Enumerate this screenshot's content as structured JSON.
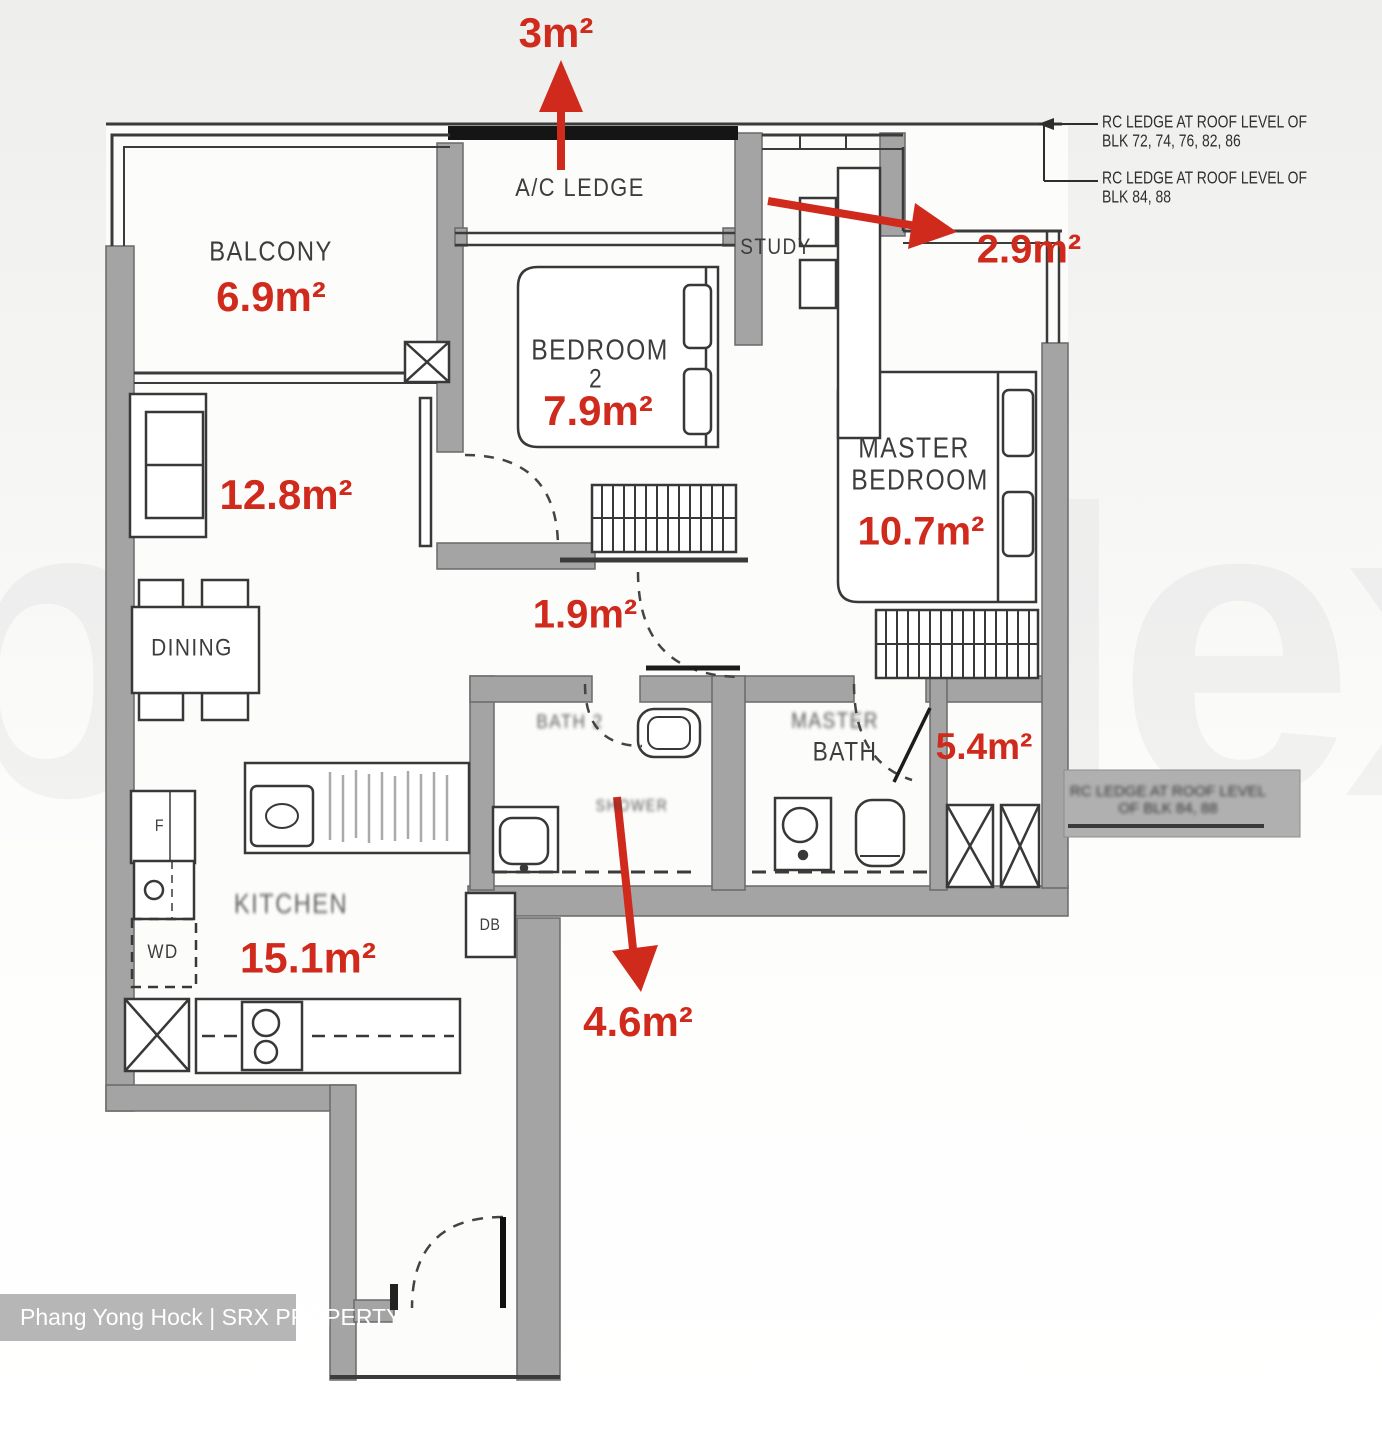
{
  "rooms": {
    "balcony": "BALCONY",
    "ac_ledge": "A/C LEDGE",
    "study": "STUDY",
    "bedroom2_line1": "BEDROOM",
    "bedroom2_line2": "2",
    "master_line1": "MASTER",
    "master_line2": "BEDROOM",
    "dining": "DINING",
    "master_bath_prefix": "MASTER",
    "master_bath": "BATH",
    "bath2": "BATH 2",
    "shower": "SHOWER",
    "kitchen": "KITCHEN"
  },
  "areas": {
    "ac_ledge": "3m²",
    "balcony": "6.9m²",
    "bedroom2": "7.9m²",
    "study": "2.9m²",
    "master_bedroom": "10.7m²",
    "living": "12.8m²",
    "hallway": "1.9m²",
    "master_bath": "5.4m²",
    "kitchen": "15.1m²",
    "foyer": "4.6m²"
  },
  "fixtures": {
    "db": "DB",
    "wd": "WD",
    "fridge": "F"
  },
  "notes": {
    "rc_note1_line1": "RC LEDGE AT ROOF LEVEL OF",
    "rc_note1_line2": "BLK 72, 74, 76, 82, 86",
    "rc_note2_line1": "RC LEDGE AT ROOF LEVEL OF",
    "rc_note2_line2": "BLK 84, 88",
    "side_ledge_line1": "RC LEDGE AT ROOF LEVEL",
    "side_ledge_line2": "OF BLK 84, 88"
  },
  "watermark_credit": "Phang Yong Hock | SRX PROPERTY",
  "background_watermark": "propNex",
  "colors": {
    "annotation_red": "#cf2a1c",
    "wall_gray": "#a4a4a4"
  }
}
